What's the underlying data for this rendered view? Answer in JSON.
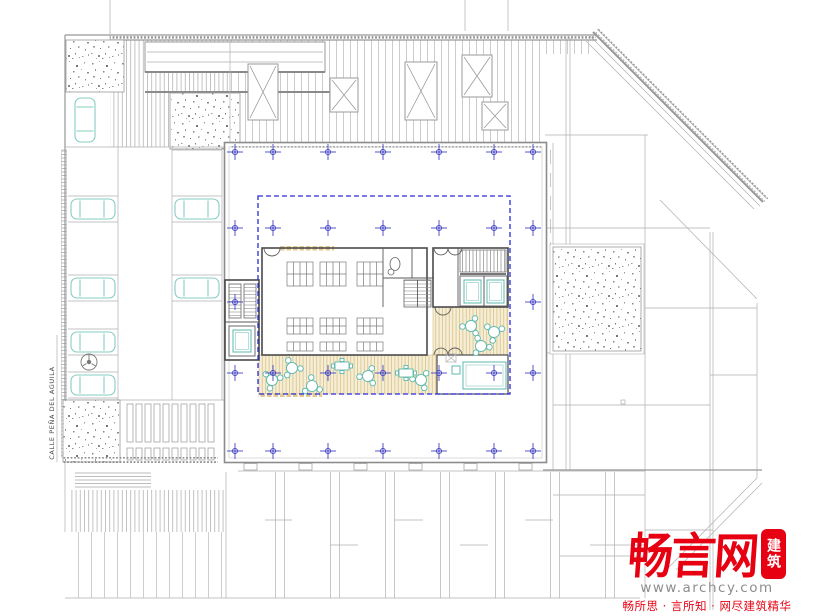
{
  "labels": {
    "street": "CALLE PEÑA DEL AGUILA"
  },
  "watermark": {
    "logo": "畅言网",
    "badge": "建筑",
    "url": "www.archcy.com",
    "slogan": "畅所思 · 言所知 · 网尽建筑精华",
    "brand_color": "#e60012"
  },
  "colors": {
    "pavement_line": "#a8a8a8",
    "wall": "#4a4a4a",
    "grid_marker": "#4444c4",
    "floor_outline": "#2a2ae0",
    "furniture_teal": "#5cb8ae",
    "wood_deck": "#dbc084",
    "stipple": "#8f8f8f"
  },
  "plan": {
    "grid": {
      "columns_x": [
        235,
        273,
        328,
        383,
        439,
        494,
        533
      ],
      "rows": [
        {
          "y": 152,
          "cols": [
            0,
            1,
            2,
            3,
            4,
            5,
            6
          ]
        },
        {
          "y": 228,
          "cols": [
            0,
            1,
            2,
            3,
            4,
            5,
            6
          ]
        },
        {
          "y": 302,
          "cols": [
            0,
            6
          ]
        },
        {
          "y": 373,
          "cols": [
            0,
            1,
            2,
            3,
            4,
            5,
            6
          ]
        },
        {
          "y": 451,
          "cols": [
            0,
            1,
            2,
            3,
            4,
            5,
            6
          ]
        }
      ]
    },
    "parking_cars": {
      "horizontal": [
        [
          93,
          209
        ],
        [
          93,
          288
        ],
        [
          93,
          342
        ],
        [
          93,
          385
        ],
        [
          197,
          209
        ],
        [
          197,
          288
        ]
      ],
      "vertical": [
        [
          85,
          120
        ]
      ]
    },
    "reading_tables": {
      "columns_x": [
        287,
        320,
        357
      ],
      "width": 26,
      "rows": [
        {
          "y": 262,
          "height": 24,
          "split": 2
        },
        {
          "y": 318,
          "height": 16,
          "split": 2
        },
        {
          "y": 342,
          "height": 9,
          "split": 1
        }
      ]
    },
    "round_tables": [
      [
        272,
        380
      ],
      [
        292,
        368
      ],
      [
        312,
        386
      ],
      [
        368,
        376
      ],
      [
        421,
        380
      ],
      [
        471,
        326
      ],
      [
        494,
        332
      ],
      [
        481,
        346
      ]
    ],
    "rect_tables": [
      [
        342,
        366
      ],
      [
        406,
        373
      ]
    ],
    "skylights": [
      [
        248,
        64,
        30,
        56
      ],
      [
        330,
        78,
        28,
        34
      ],
      [
        405,
        62,
        32,
        58
      ],
      [
        462,
        55,
        30,
        42
      ],
      [
        482,
        102,
        26,
        28
      ]
    ],
    "slat_block": {
      "x": 127,
      "y": 404,
      "columns": 10,
      "pitch": 9
    }
  }
}
